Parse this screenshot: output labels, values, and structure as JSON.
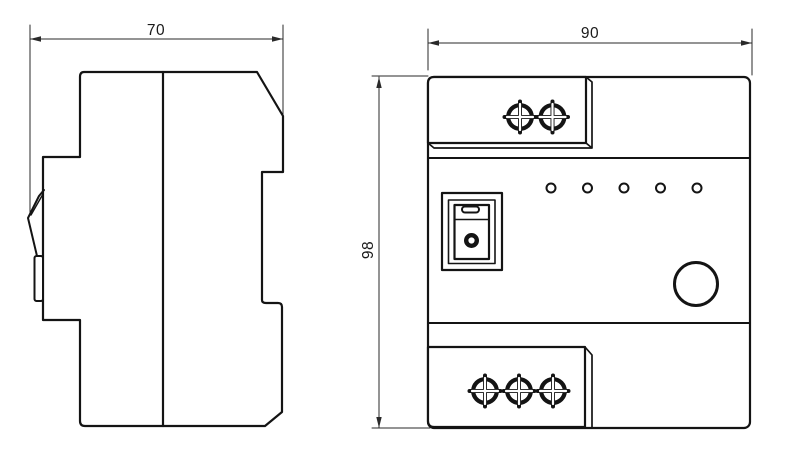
{
  "page": {
    "background": "#ffffff"
  },
  "drawing": {
    "line_color": "#141414",
    "dimension_line_color": "#2a2a2a",
    "side_view": {
      "width_dimension": "70"
    },
    "front_view": {
      "width_dimension": "90",
      "height_dimension": "98",
      "led_count": 5,
      "top_terminal_screw_count": 2,
      "bottom_terminal_screw_count": 3
    }
  }
}
